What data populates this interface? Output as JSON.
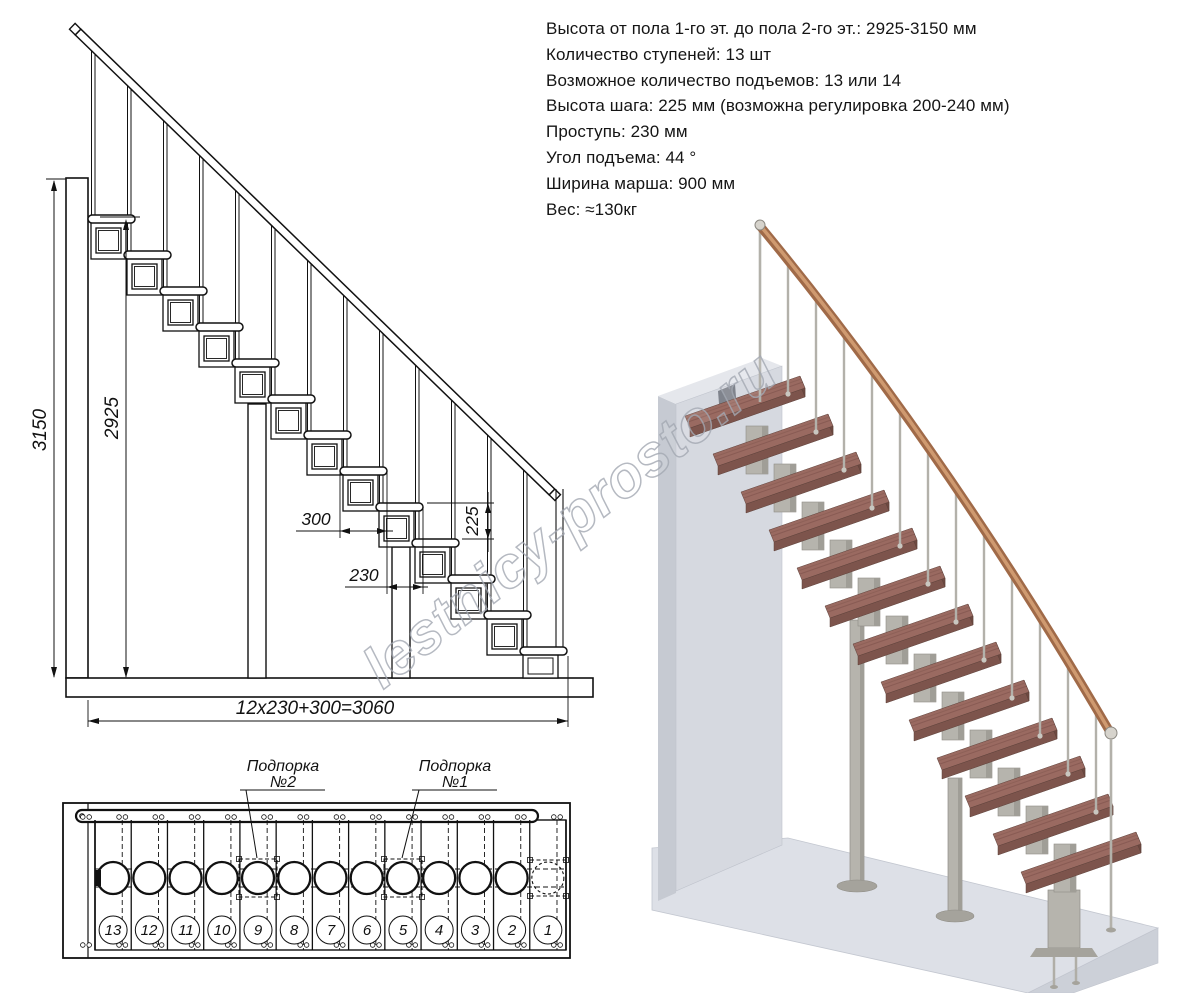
{
  "specs": {
    "lines": [
      "Высота от пола 1-го эт. до пола 2-го эт.: 2925-3150 мм",
      "Количество ступеней: 13 шт",
      "Возможное количество подъемов: 13 или 14",
      "Высота шага: 225 мм (возможна регулировка 200-240 мм)",
      "Проступь: 230 мм",
      "Угол подъема: 44 °",
      "Ширина марша: 900 мм",
      "Вес: ≈130кг"
    ]
  },
  "side_view": {
    "dims": {
      "total_height": "3150",
      "floor_height": "2925",
      "tread_depth": "300",
      "run": "230",
      "rise": "225",
      "total_length": "12x230+300=3060"
    }
  },
  "plan_view": {
    "support2": {
      "line1": "Подпорка",
      "line2": "№2"
    },
    "support1": {
      "line1": "Подпорка",
      "line2": "№1"
    },
    "step_numbers": [
      "13",
      "12",
      "11",
      "10",
      "9",
      "8",
      "7",
      "6",
      "5",
      "4",
      "3",
      "2",
      "1"
    ]
  },
  "watermark": {
    "text": "lestnicy-prosto.ru"
  },
  "colors": {
    "line": "#111111",
    "tread_top": "#9a6a61",
    "tread_front": "#7d544c",
    "tread_side": "#6d4840",
    "handrail": "#a06a48",
    "handrail_light": "#cf9a70",
    "metal": "#b6b4ad",
    "metal_shade": "#a09e97",
    "wall": "#d6d9e0",
    "wall_side": "#c6cad2",
    "wall_top": "#e5e7ec",
    "floor": "#dde0e7",
    "floor_side": "#ccd0d8",
    "watermark": "#a2a8b1"
  }
}
